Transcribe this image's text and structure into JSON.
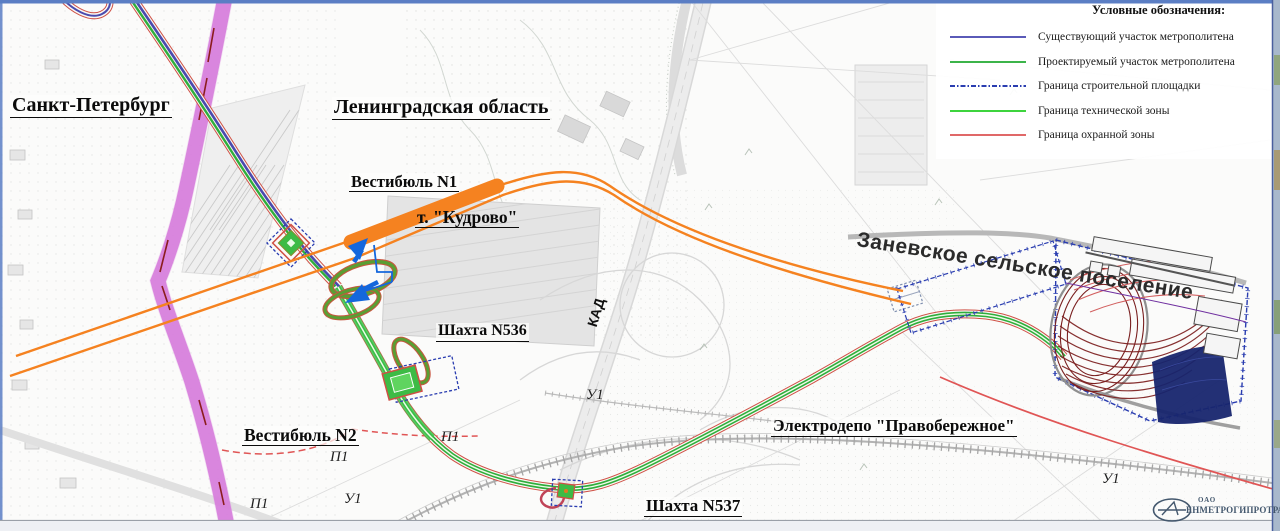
{
  "map": {
    "regions": {
      "spb": "Санкт-Петербург",
      "len_oblast": "Ленинградская область",
      "zanevskoe": "Заневское сельское поселение"
    },
    "objects": {
      "vestibule_n1": "Вестибюль N1",
      "station_kudrovo": "т. \"Кудрово\"",
      "shaft_536": "Шахта N536",
      "vestibule_n2": "Вестибюль N2",
      "shaft_537": "Шахта N537",
      "depot": "Электродепо \"Правобережное\""
    },
    "roads": {
      "kad": "КАД",
      "p1": "П1",
      "u1": "У1"
    }
  },
  "legend": {
    "title": "Условные обозначения:",
    "items": [
      {
        "label": "Существующий участок метрополитена",
        "color": "#5a5ab8",
        "swatch_css": "height:2px;margin-top:5px;background:#5a5ab8"
      },
      {
        "label": "Проектируемый участок метрополитена",
        "color": "#3cb44a",
        "swatch_css": "height:2px;margin-top:5px;background:#3cb44a"
      },
      {
        "label": "Граница строительной площадки",
        "color": "#2a3db0",
        "swatch_css": "height:2px;margin-top:5px;background:repeating-linear-gradient(90deg,#2a3db0 0 5px,rgba(0,0,0,0) 5px 7px,#2a3db0 7px 8.5px,rgba(0,0,0,0) 8.5px 10.5px)"
      },
      {
        "label": "Граница технической зоны",
        "color": "#3ed43e",
        "swatch_css": "height:2px;margin-top:5px;background:#3ed43e"
      },
      {
        "label": "Граница охранной зоны",
        "color": "#e06868",
        "swatch_css": "height:2px;margin-top:5px;background:#e06868"
      }
    ]
  },
  "logo": {
    "org_type": "ОАО",
    "name": "ЕНМЕТРОГИПРОТРАНС"
  },
  "colors": {
    "existing_metro": "#4a4aae",
    "projected_metro": "#2fae3c",
    "construction_boundary": "#2a3db0",
    "technical_zone": "#3ec24a",
    "guard_zone": "#e05555",
    "tunnel_orange": "#f58220",
    "road_magenta": "#d36fd8"
  }
}
